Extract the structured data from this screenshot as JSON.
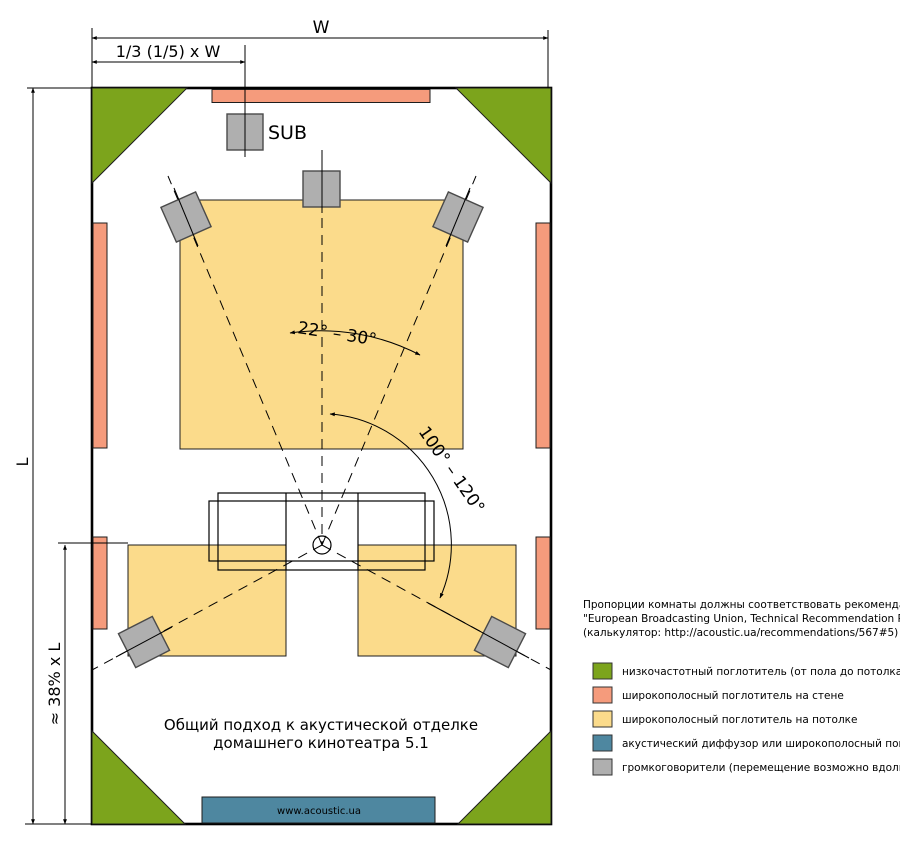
{
  "dimensions": {
    "width": "W",
    "width_fraction": "1/3 (1/5) x W",
    "length": "L",
    "length_fraction": "≈ 38% x L"
  },
  "room": {
    "sub_label": "SUB",
    "front_angle": "22° – 30°",
    "surround_angle": "100° – 120°",
    "caption_line1": "Общий подход к акустической отделке",
    "caption_line2": "домашнего кинотеатра 5.1",
    "diffuser_text": "www.acoustic.ua"
  },
  "note": {
    "line1": "Пропорции комнаты должны соответствовать рекомендациям",
    "line2": "\"European Broadcasting Union, Technical Recommendation R22–1998\"",
    "line3": "(калькулятор: http://acoustic.ua/recommendations/567#5)"
  },
  "legend": {
    "items": [
      {
        "color": "#7CA41C",
        "label": "низкочастотный поглотитель (от пола до потолка)"
      },
      {
        "color": "#F59B7C",
        "label": "широкополосный поглотитель на стене"
      },
      {
        "color": "#FBDB8B",
        "label": "широкополосный поглотитель на потолке"
      },
      {
        "color": "#4E87A0",
        "label": "акустический диффузор или широкополосный поглотитель"
      },
      {
        "color": "#AFAFAF",
        "label": "громкоговорители (перемещение возможно вдоль осей)"
      }
    ]
  },
  "colors": {
    "bass_absorber": "#7CA41C",
    "wall_absorber": "#F59B7C",
    "ceiling_absorber": "#FBDB8B",
    "diffuser": "#4E87A0",
    "loudspeaker": "#AFAFAF",
    "lines": "#000000"
  }
}
